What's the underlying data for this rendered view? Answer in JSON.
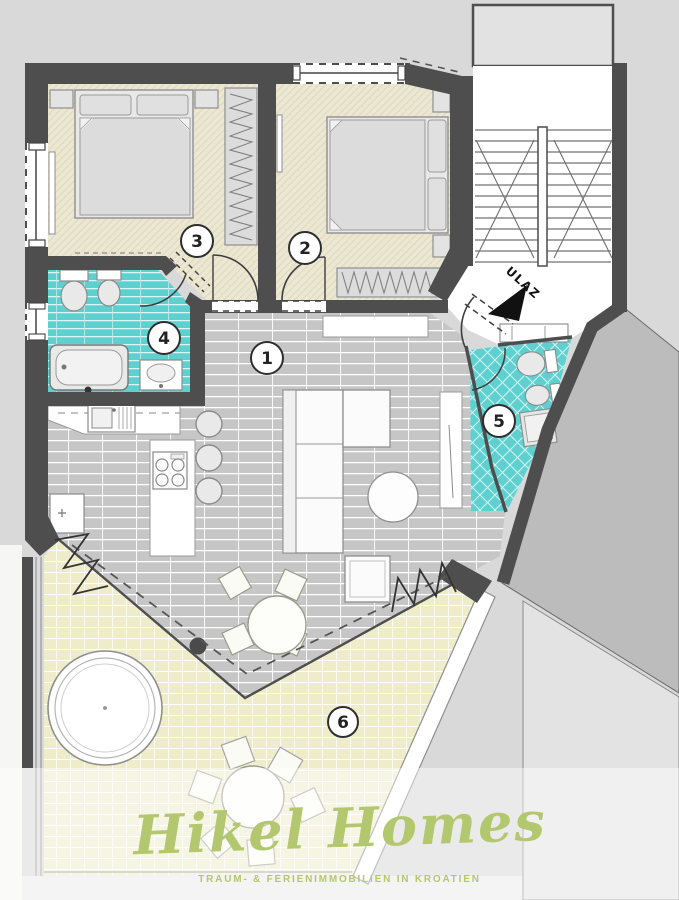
{
  "plan": {
    "entrance_label": "ULAZ",
    "room_labels": [
      "1",
      "2",
      "3",
      "4",
      "5",
      "6"
    ]
  },
  "branding": {
    "logo_text": "Hikel Homes",
    "tagline": "TRAUM- & FERIENIMMOBILIEN IN KROATIEN"
  },
  "colors": {
    "background": "#d9d9d9",
    "wall": "#4e4e4e",
    "bathroom_tile": "#5fd0d0",
    "living_tile": "#c7c7c7",
    "bedroom_floor": "#ece8d3",
    "terrace_floor": "#f0edcc",
    "brand_green": "#b3c76e"
  }
}
